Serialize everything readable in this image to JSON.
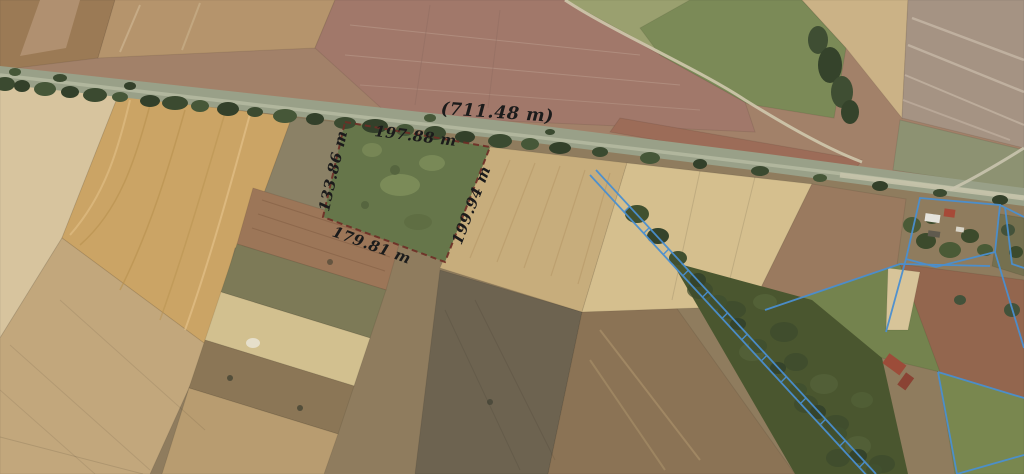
{
  "map": {
    "view": "aerial-parcel-survey",
    "measurements": {
      "road_total_label": "(711.48 m)",
      "parcel_top_label": "197.88 m",
      "parcel_left_label": "133.86 m",
      "parcel_right_label": "199.94 m",
      "parcel_bottom_label": "179.81 m"
    },
    "colors": {
      "measurement_text": "#1b1b1b",
      "cadastral_line": "#4a8fd0",
      "parcel_dash": "#6e2d26"
    }
  }
}
